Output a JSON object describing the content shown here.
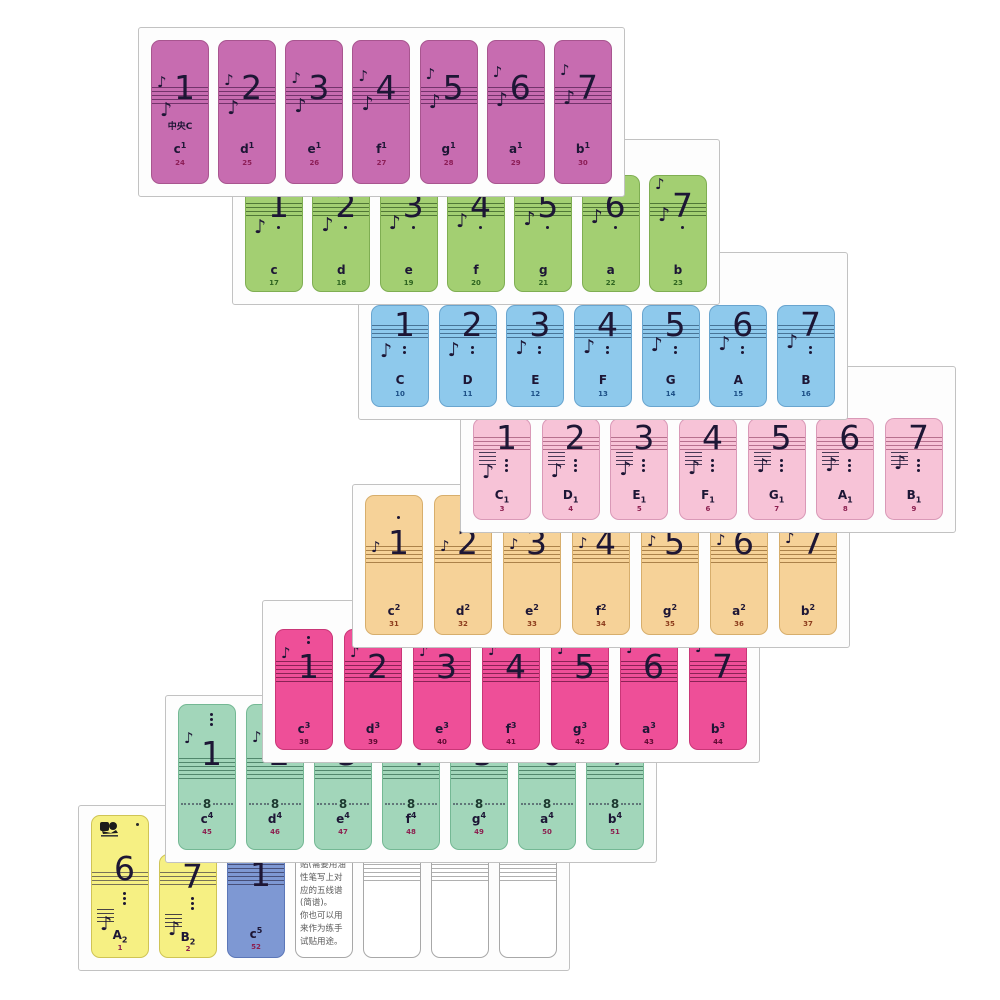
{
  "glyphs": {
    "eighth_note": "♪"
  },
  "page": {
    "background": "#ffffff",
    "sheet_bg": "#fdfdfd",
    "sheet_border": "#c2c2c2"
  },
  "cards": [
    {
      "name": "octave-one-line-c1-b1",
      "color": "#c76cb0",
      "border": "#a8558f",
      "staff_line": "rgba(70,20,70,0.65)",
      "id_color": "#8c1d56",
      "octave_dots": {
        "pos": "none",
        "count": 0
      },
      "stickers": [
        {
          "number": "1",
          "label": "中央C",
          "name_base": "c",
          "mark": "1",
          "mark_pos": "sup",
          "id": "24"
        },
        {
          "number": "2",
          "name_base": "d",
          "mark": "1",
          "mark_pos": "sup",
          "id": "25"
        },
        {
          "number": "3",
          "name_base": "e",
          "mark": "1",
          "mark_pos": "sup",
          "id": "26"
        },
        {
          "number": "4",
          "name_base": "f",
          "mark": "1",
          "mark_pos": "sup",
          "id": "27"
        },
        {
          "number": "5",
          "name_base": "g",
          "mark": "1",
          "mark_pos": "sup",
          "id": "28"
        },
        {
          "number": "6",
          "name_base": "a",
          "mark": "1",
          "mark_pos": "sup",
          "id": "29"
        },
        {
          "number": "7",
          "name_base": "b",
          "mark": "1",
          "mark_pos": "sup",
          "id": "30"
        }
      ]
    },
    {
      "name": "octave-small-c-b",
      "color": "#a3cf72",
      "border": "#7fae52",
      "staff_line": "rgba(25,60,15,0.6)",
      "id_color": "#2e6420",
      "octave_dots": {
        "pos": "below",
        "count": 1
      },
      "stickers": [
        {
          "number": "1",
          "name_base": "c",
          "id": "17"
        },
        {
          "number": "2",
          "name_base": "d",
          "id": "18"
        },
        {
          "number": "3",
          "name_base": "e",
          "id": "19"
        },
        {
          "number": "4",
          "name_base": "f",
          "id": "20"
        },
        {
          "number": "5",
          "name_base": "g",
          "id": "21"
        },
        {
          "number": "6",
          "name_base": "a",
          "id": "22"
        },
        {
          "number": "7",
          "name_base": "b",
          "id": "23"
        }
      ]
    },
    {
      "name": "octave-great-C-B",
      "color": "#8ec9ec",
      "border": "#69a5cf",
      "staff_line": "rgba(15,45,80,0.55)",
      "id_color": "#1c4f86",
      "octave_dots": {
        "pos": "below",
        "count": 2
      },
      "stickers": [
        {
          "number": "1",
          "name_base": "C",
          "id": "10"
        },
        {
          "number": "2",
          "name_base": "D",
          "id": "11"
        },
        {
          "number": "3",
          "name_base": "E",
          "id": "12"
        },
        {
          "number": "4",
          "name_base": "F",
          "id": "13"
        },
        {
          "number": "5",
          "name_base": "G",
          "id": "14"
        },
        {
          "number": "6",
          "name_base": "A",
          "id": "15"
        },
        {
          "number": "7",
          "name_base": "B",
          "id": "16"
        }
      ]
    },
    {
      "name": "octave-contra-C1-B1",
      "color": "#f7c3d7",
      "border": "#d999b7",
      "staff_line": "rgba(120,30,70,0.5)",
      "id_color": "#8c2050",
      "octave_dots": {
        "pos": "below",
        "count": 3
      },
      "stickers": [
        {
          "number": "1",
          "name_base": "C",
          "mark": "1",
          "mark_pos": "sub",
          "id": "3"
        },
        {
          "number": "2",
          "name_base": "D",
          "mark": "1",
          "mark_pos": "sub",
          "id": "4"
        },
        {
          "number": "3",
          "name_base": "E",
          "mark": "1",
          "mark_pos": "sub",
          "id": "5"
        },
        {
          "number": "4",
          "name_base": "F",
          "mark": "1",
          "mark_pos": "sub",
          "id": "6"
        },
        {
          "number": "5",
          "name_base": "G",
          "mark": "1",
          "mark_pos": "sub",
          "id": "7"
        },
        {
          "number": "6",
          "name_base": "A",
          "mark": "1",
          "mark_pos": "sub",
          "id": "8"
        },
        {
          "number": "7",
          "name_base": "B",
          "mark": "1",
          "mark_pos": "sub",
          "id": "9"
        }
      ]
    },
    {
      "name": "octave-two-line-c2-b2",
      "color": "#f6d298",
      "border": "#d7ae6c",
      "staff_line": "rgba(110,65,10,0.55)",
      "id_color": "#8c3c1c",
      "octave_dots": {
        "pos": "above",
        "count": 1
      },
      "stickers": [
        {
          "number": "1",
          "name_base": "c",
          "mark": "2",
          "mark_pos": "sup",
          "id": "31"
        },
        {
          "number": "2",
          "name_base": "d",
          "mark": "2",
          "mark_pos": "sup",
          "id": "32"
        },
        {
          "number": "3",
          "name_base": "e",
          "mark": "2",
          "mark_pos": "sup",
          "id": "33"
        },
        {
          "number": "4",
          "name_base": "f",
          "mark": "2",
          "mark_pos": "sup",
          "id": "34"
        },
        {
          "number": "5",
          "name_base": "g",
          "mark": "2",
          "mark_pos": "sup",
          "id": "35"
        },
        {
          "number": "6",
          "name_base": "a",
          "mark": "2",
          "mark_pos": "sup",
          "id": "36"
        },
        {
          "number": "7",
          "name_base": "b",
          "mark": "2",
          "mark_pos": "sup",
          "id": "37"
        }
      ]
    },
    {
      "name": "octave-three-line-c3-b3",
      "color": "#ee4f98",
      "border": "#c93677",
      "staff_line": "rgba(70,5,40,0.6)",
      "id_color": "#5e0a32",
      "octave_dots": {
        "pos": "above",
        "count": 2
      },
      "stickers": [
        {
          "number": "1",
          "name_base": "c",
          "mark": "3",
          "mark_pos": "sup",
          "id": "38"
        },
        {
          "number": "2",
          "name_base": "d",
          "mark": "3",
          "mark_pos": "sup",
          "id": "39"
        },
        {
          "number": "3",
          "name_base": "e",
          "mark": "3",
          "mark_pos": "sup",
          "id": "40"
        },
        {
          "number": "4",
          "name_base": "f",
          "mark": "3",
          "mark_pos": "sup",
          "id": "41"
        },
        {
          "number": "5",
          "name_base": "g",
          "mark": "3",
          "mark_pos": "sup",
          "id": "42"
        },
        {
          "number": "6",
          "name_base": "a",
          "mark": "3",
          "mark_pos": "sup",
          "id": "43"
        },
        {
          "number": "7",
          "name_base": "b",
          "mark": "3",
          "mark_pos": "sup",
          "id": "44"
        }
      ]
    },
    {
      "name": "octave-four-line-c4-b4",
      "color": "#a2d6ba",
      "border": "#74b894",
      "staff_line": "rgba(15,70,45,0.55)",
      "id_color": "#8c2050",
      "octave_dots": {
        "pos": "above",
        "count": 3
      },
      "eight_label": "8",
      "stickers": [
        {
          "number": "1",
          "name_base": "c",
          "mark": "4",
          "mark_pos": "sup",
          "id": "45"
        },
        {
          "number": "2",
          "name_base": "d",
          "mark": "4",
          "mark_pos": "sup",
          "id": "46"
        },
        {
          "number": "3",
          "name_base": "e",
          "mark": "4",
          "mark_pos": "sup",
          "id": "47"
        },
        {
          "number": "4",
          "name_base": "f",
          "mark": "4",
          "mark_pos": "sup",
          "id": "48"
        },
        {
          "number": "5",
          "name_base": "g",
          "mark": "4",
          "mark_pos": "sup",
          "id": "49"
        },
        {
          "number": "6",
          "name_base": "a",
          "mark": "4",
          "mark_pos": "sup",
          "id": "50"
        },
        {
          "number": "7",
          "name_base": "b",
          "mark": "4",
          "mark_pos": "sup",
          "id": "51"
        }
      ]
    },
    {
      "name": "sheet-extremes-and-blanks",
      "color": "#ffffff",
      "border": "#a8a8a8",
      "staff_line": "rgba(60,60,60,0.5)",
      "id_color": "#8c2050",
      "stickers": [
        {
          "type": "note",
          "color": "#f6f083",
          "border": "#cfc455",
          "number": "6",
          "name_base": "A",
          "mark": "2",
          "mark_pos": "sub",
          "id": "1",
          "logo": true,
          "octave_dots": {
            "pos": "below",
            "count": 3
          }
        },
        {
          "type": "note",
          "color": "#f6f083",
          "border": "#cfc455",
          "number": "7",
          "name_base": "B",
          "mark": "2",
          "mark_pos": "sub",
          "id": "2",
          "octave_dots": {
            "pos": "below",
            "count": 3
          }
        },
        {
          "type": "note",
          "color": "#7e98d3",
          "border": "#5c77b8",
          "number": "1",
          "name_base": "c",
          "mark": "5",
          "mark_pos": "sup",
          "id": "52",
          "dash_above": true,
          "octave_dots": {
            "pos": "none",
            "count": 0
          }
        },
        {
          "type": "instruction",
          "lines": [
            "贴(需要用油",
            "性笔写上对",
            "应的五线谱",
            "(简谱)。",
            "你也可以用",
            "来作为练手",
            "试贴用途。"
          ]
        },
        {
          "type": "blank"
        },
        {
          "type": "blank"
        },
        {
          "type": "blank"
        }
      ]
    }
  ]
}
